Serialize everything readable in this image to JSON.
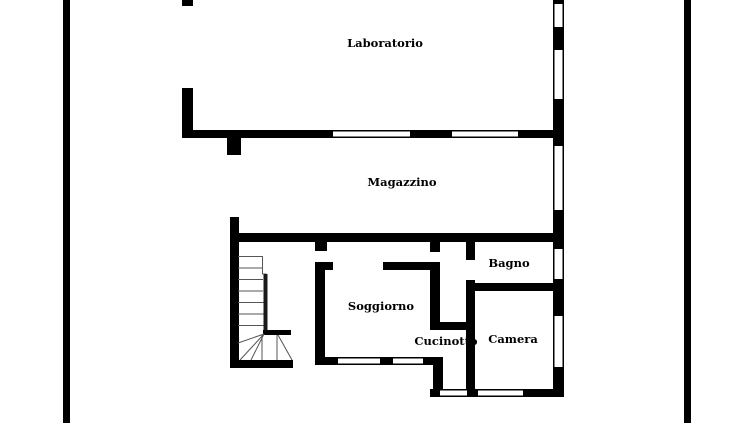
{
  "drawing": {
    "type": "floor-plan",
    "background_color": "#ffffff",
    "wall_color": "#000000",
    "stair_line_color": "#555555"
  },
  "rooms": [
    {
      "label": "Laboratorio"
    },
    {
      "label": "Magazzino"
    },
    {
      "label": "Bagno"
    },
    {
      "label": "Soggiorno"
    },
    {
      "label": "Cucinotto"
    },
    {
      "label": "Camera"
    }
  ]
}
